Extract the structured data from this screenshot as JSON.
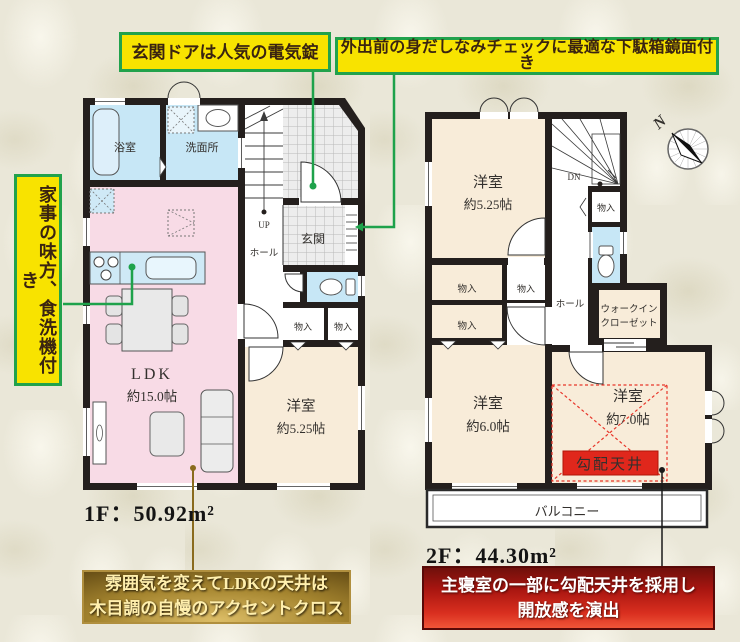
{
  "callouts": {
    "entrance_door": "玄関ドアは人気の電気錠",
    "shoebox_mirror": "外出前の身だしなみチェックに最適な下駄箱鏡面付き",
    "dishwasher": "家事の味方、食洗機付き",
    "ldk_ceiling": {
      "line1": "雰囲気を変えてLDKの天井は",
      "line2": "木目調の自慢のアクセントクロス"
    },
    "sloped_ceiling": {
      "line1": "主寝室の一部に勾配天井を採用し",
      "line2": "開放感を演出"
    }
  },
  "floor1": {
    "area_label": "1F：50.92m²",
    "bath": "浴室",
    "washroom": "洗面所",
    "entrance": "玄関",
    "hall": "ホール",
    "stairs_up": "UP",
    "ldk": {
      "name": "LDK",
      "size": "約15.0帖"
    },
    "bedroom": {
      "name": "洋室",
      "size": "約5.25帖"
    },
    "storage1": "物入",
    "storage2": "物入"
  },
  "floor2": {
    "area_label": "2F：44.30m²",
    "stairs_down": "DN",
    "hall": "ホール",
    "bedroom1": {
      "name": "洋室",
      "size": "約5.25帖"
    },
    "bedroom2": {
      "name": "洋室",
      "size": "約6.0帖"
    },
    "bedroom3": {
      "name": "洋室",
      "size": "約7.0帖"
    },
    "storage1": "物入",
    "storage2": "物入",
    "storage3": "物入",
    "storage4": "物入",
    "wic": {
      "line1": "ウォークイン",
      "line2": "クローゼット"
    },
    "balcony": "バルコニー",
    "sloped_ceiling_tag": "勾配天井"
  },
  "compass": {
    "label": "N"
  },
  "colors": {
    "callout_yellow": "#f8e300",
    "callout_green": "#21a24c",
    "wall": "#241f1d",
    "ldk_pink": "#f8dbe6",
    "wet_blue": "#c7e7f6",
    "room_beige": "#f8ecd9",
    "accent_red": "#e0271c",
    "gold_line": "#8a6b1e"
  }
}
